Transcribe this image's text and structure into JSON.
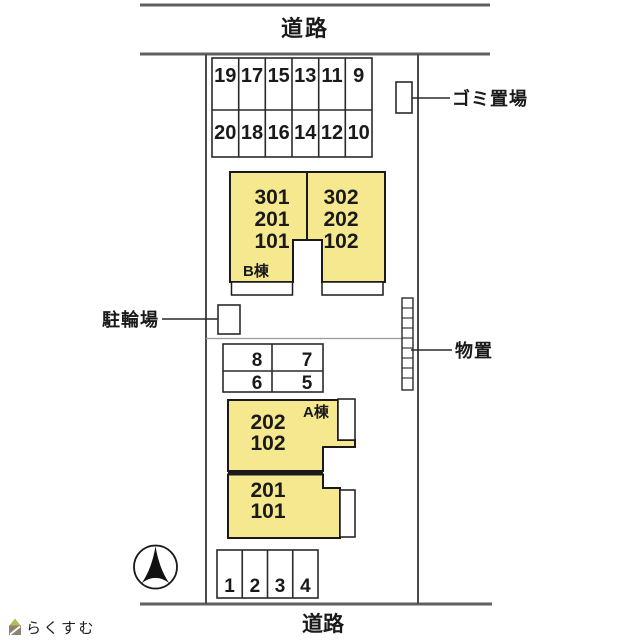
{
  "roads": {
    "top": "道路",
    "bottom": "道路"
  },
  "parking_lot_top": {
    "row1": [
      "19",
      "17",
      "15",
      "13",
      "11",
      "9"
    ],
    "row2": [
      "20",
      "18",
      "16",
      "14",
      "12",
      "10"
    ]
  },
  "parking_lot_mid": {
    "row1": [
      "8",
      "7"
    ],
    "row2": [
      "6",
      "5"
    ]
  },
  "parking_lot_bottom": [
    "1",
    "2",
    "3",
    "4"
  ],
  "building_b": {
    "name": "B棟",
    "left_units": [
      "301",
      "201",
      "101"
    ],
    "right_units": [
      "302",
      "202",
      "102"
    ]
  },
  "building_a": {
    "name": "A棟",
    "upper_units": [
      "202",
      "102"
    ],
    "lower_units": [
      "201",
      "101"
    ]
  },
  "facilities": {
    "garbage": "ゴミ置場",
    "bicycle_parking": "駐輪場",
    "storage": "物置"
  },
  "watermark": {
    "brand": "らくすむ"
  },
  "colors": {
    "building_fill": "#F5E88F",
    "outline": "#1a1a1a",
    "road_line": "#606060",
    "boundary_line": "#4a4a4a",
    "grid_line": "#2a2a2a",
    "watermark_text": "#998c7e",
    "watermark_olive": "#b4bb55",
    "watermark_brown": "#8d8171"
  }
}
